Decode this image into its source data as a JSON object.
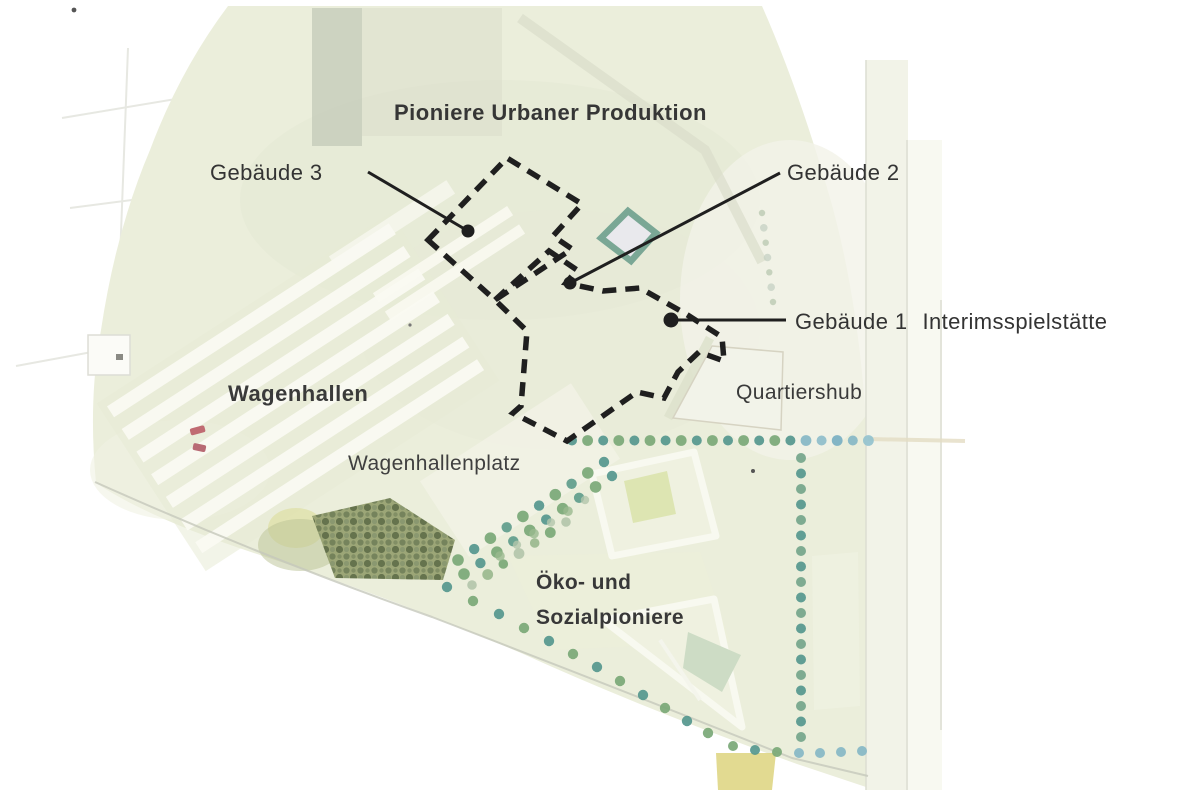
{
  "title": "Pioniere Urbaner Produktion",
  "labels": {
    "gebaeude3": "Gebäude 3",
    "gebaeude2": "Gebäude 2",
    "gebaeude1_num": "Gebäude 1",
    "gebaeude1_name": "Interimsspielstätte",
    "wagenhallen": "Wagenhallen",
    "wagenhallenplatz": "Wagenhallenplatz",
    "quartiershub": "Quartiershub",
    "oeko_line1": "Öko- und",
    "oeko_line2": "Sozialpioniere"
  },
  "colors": {
    "background": "#ffffff",
    "map_green": "#ebeedb",
    "map_green_light": "#f2f3e6",
    "gray_green_band": "#c7cdbb",
    "building_white": "#fafaf2",
    "outline_dash": "#1f1f1f",
    "label_text": "#333333",
    "teal_square": "#7aa795",
    "dot_teal": "#55978e",
    "dot_green": "#7aa877",
    "dot_blue": "#86b7c6",
    "dot_pale": "#b3c5ab",
    "tree_base": "#98a272",
    "tree_dark": "#5e6c46",
    "courtyard_green": "#dde5b2",
    "yellow_patch": "#ddd47e",
    "red_mark": "#c06b72"
  }
}
